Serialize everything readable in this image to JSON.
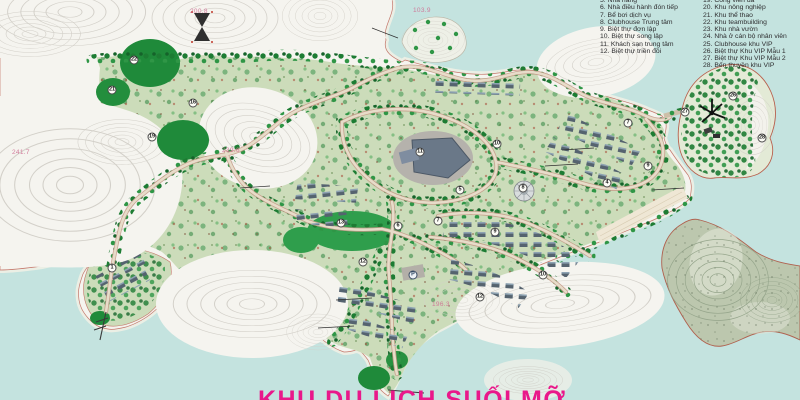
{
  "title": {
    "clipped_text": "KHU DU LỊCH SUỐI MỠ",
    "note_color": "#e9188a"
  },
  "legend": {
    "column1": [
      "5. Nhà hàng",
      "6. Nhà điều hành đón tiếp",
      "7. Bể bơi dịch vụ",
      "8. Clubhouse Trung tâm",
      "9. Biệt thự đơn lập",
      "10. Biệt thự song lập",
      "11. Khách sạn trung tâm",
      "12. Biệt thự triền đồi"
    ],
    "column2": [
      "19. Công viên đá",
      "20. Khu nông nghiệp",
      "21. Khu thể thao",
      "22. Khu teambuilding",
      "23. Khu nhà vườn",
      "24. Nhà ở cán bộ nhân viên",
      "25. Clubhouse khu VIP",
      "26. Biệt thự Khu VIP Mẫu 1",
      "27. Biệt thự Khu VIP Mẫu 2",
      "28. Bến thuyền khu VIP"
    ]
  },
  "map": {
    "markers": [
      {
        "label": "22",
        "x": 134,
        "y": 60
      },
      {
        "label": "21",
        "x": 112,
        "y": 90
      },
      {
        "label": "16",
        "x": 193,
        "y": 103
      },
      {
        "label": "19",
        "x": 152,
        "y": 137
      },
      {
        "label": "11",
        "x": 420,
        "y": 152
      },
      {
        "label": "10",
        "x": 497,
        "y": 144
      },
      {
        "label": "5",
        "x": 460,
        "y": 190
      },
      {
        "label": "8",
        "x": 523,
        "y": 188
      },
      {
        "label": "7",
        "x": 438,
        "y": 221
      },
      {
        "label": "13",
        "x": 341,
        "y": 223
      },
      {
        "label": "6",
        "x": 398,
        "y": 226
      },
      {
        "label": "12",
        "x": 363,
        "y": 262
      },
      {
        "label": "9",
        "x": 495,
        "y": 232
      },
      {
        "label": "10",
        "x": 543,
        "y": 275
      },
      {
        "label": "12",
        "x": 480,
        "y": 297
      },
      {
        "label": "4",
        "x": 607,
        "y": 183
      },
      {
        "label": "9",
        "x": 648,
        "y": 166
      },
      {
        "label": "7",
        "x": 628,
        "y": 123
      },
      {
        "label": "27",
        "x": 685,
        "y": 112
      },
      {
        "label": "26",
        "x": 733,
        "y": 96
      },
      {
        "label": "28",
        "x": 762,
        "y": 138
      },
      {
        "label": "1",
        "x": 112,
        "y": 268
      },
      {
        "label": "P",
        "x": 413,
        "y": 275
      }
    ],
    "elevation_labels": [
      {
        "text": "200.8",
        "x": 190,
        "y": 8
      },
      {
        "text": "103.9",
        "x": 413,
        "y": 7
      },
      {
        "text": "241.7",
        "x": 12,
        "y": 149
      },
      {
        "text": "239.6",
        "x": 222,
        "y": 147
      },
      {
        "text": "196.3",
        "x": 432,
        "y": 301
      }
    ],
    "icons": [
      {
        "name": "hourglass-survey-marker",
        "x": 202,
        "y": 27
      },
      {
        "name": "windmill",
        "x": 712,
        "y": 113
      }
    ],
    "colors": {
      "water": "#c4e3df",
      "bare_land": "#f5f4ef",
      "contour_line": "#d2cfc7",
      "vegetation_light": "#ccdcba",
      "vegetation_dark": "#1f8a3a",
      "road": "#e7dcc9",
      "road_edge": "#c49886",
      "building_roof": "#55636f",
      "rock_island": "#bcc7ae",
      "shore_outline": "#c4766a",
      "title_pink": "#e9188a",
      "elevation_pink": "#cf7094",
      "legend_text": "#2e2e30"
    }
  }
}
